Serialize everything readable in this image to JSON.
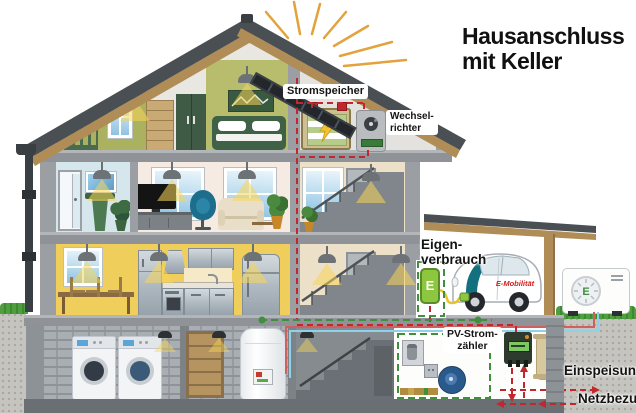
{
  "title": {
    "line1": "Hausanschluss",
    "line2": "mit Keller"
  },
  "labels": {
    "storage": "Stromspeicher",
    "inverter": [
      "Wechsel-",
      "richter"
    ],
    "self_consumption": [
      "Eigen-",
      "verbrauch"
    ],
    "pv_meter": [
      "PV-Strom-",
      "zähler"
    ],
    "feed_in": "Einspeisung",
    "grid_supply": "Netzbezug",
    "car_brand": "E-Mobilität",
    "wallbox_letter": "E",
    "heatpump_letter": "E"
  },
  "colors": {
    "electricity_flow_red": "#c2272d",
    "self_consumption_green": "#3f8f3f",
    "sun_ray_orange": "#e2a23c",
    "wallbox_green": "#8dc63f",
    "car_accent_teal": "#12707f",
    "roof_tile_gray": "#4a4f54",
    "wood_tan": "#b08d57",
    "attic_wall_olive": "#c3c98f",
    "kitchen_wall_yellow": "#f0ce5c"
  }
}
